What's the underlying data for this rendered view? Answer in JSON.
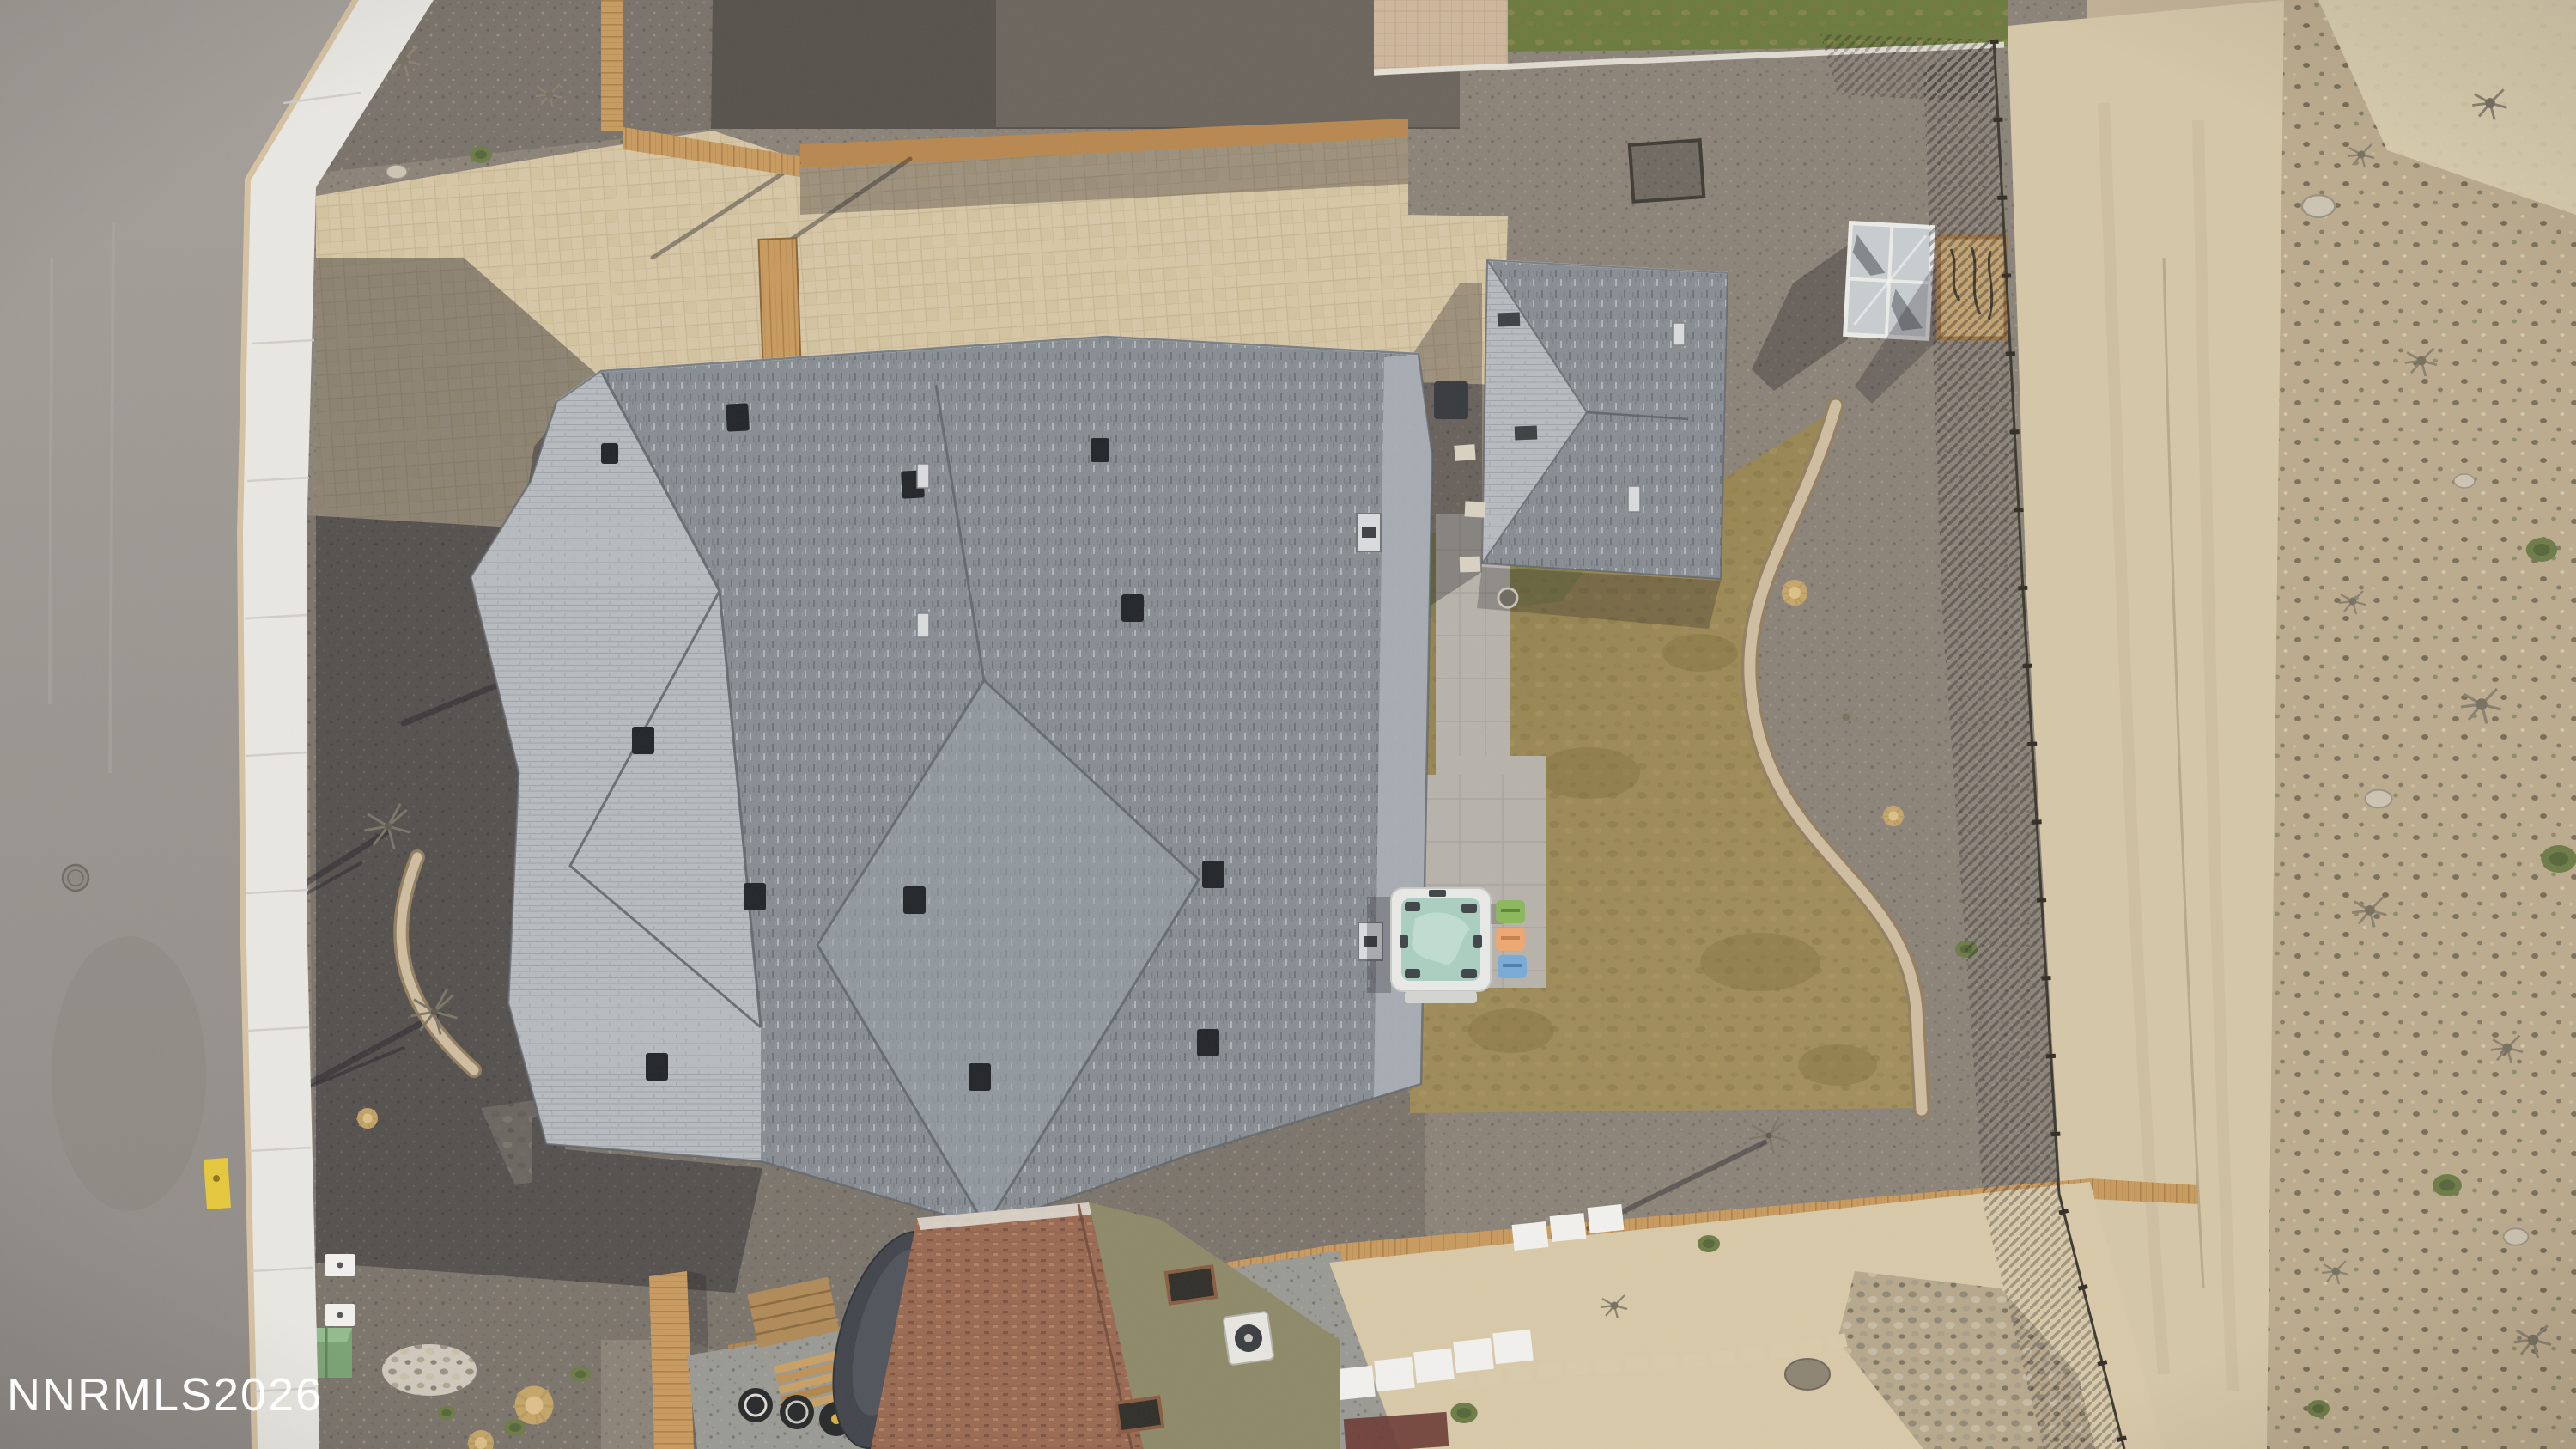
{
  "image": {
    "kind": "aerial-drone-photo",
    "description": "Top-down aerial view of a residential property: large gray-shingle roof home with paver driveway, backyard brown lawn with hot tub and three chairs, detached gray-roof garage, greenhouse, curved paver garden walls, wood fencing, street with sidewalk on the left and open desert land on the right; neighboring brown-roof house at bottom."
  },
  "watermark": {
    "text": "NNRMLS2026",
    "color": "#ffffff"
  },
  "palette": {
    "watermark": "#ffffff",
    "roadTop": "#a5a09a",
    "roadBot": "#8f8a85",
    "curb": "#d5c2a1",
    "walk": "#eae8e3",
    "walkJoint": "#cfccc5",
    "gravelBase": "#8b8378",
    "gravelFront": "#7b746b",
    "gravelTop": "#79726a",
    "gravelShadowDark": "#56514a",
    "gravelShadow2": "#6b645c",
    "gravelBlue": "#9a9a94",
    "paver": "#d7c7a6",
    "paverJoint": "#c2b08e",
    "paverPink": "#cdb69b",
    "fence": "#c89a5e",
    "fenceDark": "#a87c44",
    "fenceDim": "#b8874f",
    "fenceWire": "#3b382e",
    "roofDark": "#878d92",
    "roofLight": "#b7bbbf",
    "roofMid": "#9aa1a7",
    "roofRight": "#a8aeb4",
    "ridge": "#61666b",
    "roofHighlight": "#d3d5d7",
    "vent": "#212428",
    "ventSilver": "#d9dbdd",
    "shingleDashDark": "#6c7277",
    "shingleDashLight": "#c2c6ca",
    "rowLine": "#9aa1a6",
    "lawnA": "#8c7c4b",
    "lawnB": "#a28e5c",
    "lawnDark": "#82713f",
    "lawnLight": "#b09c64",
    "grassTop": "#6b7a3d",
    "wall": "#cfbda0",
    "wallEdge": "#937f60",
    "patio": "#b7b3ab",
    "patioJoint": "#a29e96",
    "tub": "#e9eae7",
    "tubCover": "#aacfc0",
    "tubSwirl": "#c5e0d4",
    "tubPad": "#3f4449",
    "tubStep": "#d4d5d1",
    "chairGreen": "#8cb85c",
    "chairOrange": "#eda873",
    "chairBlue": "#79abd7",
    "ghGlass": "#c8cdd0",
    "ghFrame": "#ebebe8",
    "ghDark": "#53585c",
    "mesh": "#c2a371",
    "meshFrame": "#9b7444",
    "meshLine": "#453f33",
    "utilBox": "#7aa274",
    "utilBoxTop": "#93bb8c",
    "markerYellow": "#e6c83b",
    "white": "#f2f1ee",
    "brownRoof": "#9a6a52",
    "brownRoofDark": "#7d5340",
    "brownRoofLight": "#b58465",
    "brownEave": "#ded9cf",
    "olive": "#8d8968",
    "carCover": "#41454b",
    "carHi": "#6b7078",
    "tire": "#26282a",
    "lumber": "#c9a064",
    "platform": "#b08a58",
    "maroon": "#6b3a33",
    "stoneWhite": "#e5e0d5",
    "rock": "#cdc4b2",
    "rockEdge": "#9b9283",
    "rockRiver": "#b7a88c",
    "shrubGreen": "#6c7c46",
    "shrubGreenDark": "#57663a",
    "shrubDry": "#8a8070",
    "tuft": "#c9a868",
    "tuftCore": "#ddc089",
    "walkStone": "#d9d2c2",
    "manhole": "#8f8982",
    "sandPath": "#d9cbaa",
    "desertRoad": "#d5c7a7",
    "desertBase": "#c3b295",
    "desertScrub": "#bcab8d",
    "desertTop": "#dccfb0"
  },
  "scene": {
    "elements": [
      {
        "name": "street-asphalt",
        "note": "gray road, left edge"
      },
      {
        "name": "sidewalk",
        "note": "white concrete walk with curb"
      },
      {
        "name": "front-yard-gravel",
        "note": "dark gravel in house shadow, young trees, curved paver wall"
      },
      {
        "name": "utility-box",
        "note": "green box beside sidewalk"
      },
      {
        "name": "paver-driveway",
        "note": "tan paver driveway, upper left"
      },
      {
        "name": "main-house-roof",
        "note": "gray asphalt shingle hip/gable roof with vents"
      },
      {
        "name": "detached-garage-roof",
        "note": "smaller gray shingle roof, upper right"
      },
      {
        "name": "greenhouse",
        "note": "glass-top cold frame"
      },
      {
        "name": "mesh-panel",
        "note": "wood-framed screen with garden tools"
      },
      {
        "name": "backyard-lawn",
        "note": "dormant tan/brown grass"
      },
      {
        "name": "hot-tub",
        "note": "white spa with teal cover on paver patio"
      },
      {
        "name": "patio-chairs",
        "note": "green, orange and blue kids chairs"
      },
      {
        "name": "curved-garden-walls",
        "note": "tan paver retaining walls"
      },
      {
        "name": "wood-fences",
        "note": "cedar fencing around property"
      },
      {
        "name": "wire-fence",
        "note": "field fence along desert boundary"
      },
      {
        "name": "desert-lot",
        "note": "open dirt with track road and scrub"
      },
      {
        "name": "neighbor-house",
        "note": "brown shingle roof, covered car, lumber, tires, AC unit"
      },
      {
        "name": "watermark",
        "note": "MLS watermark text bottom-left"
      }
    ]
  }
}
